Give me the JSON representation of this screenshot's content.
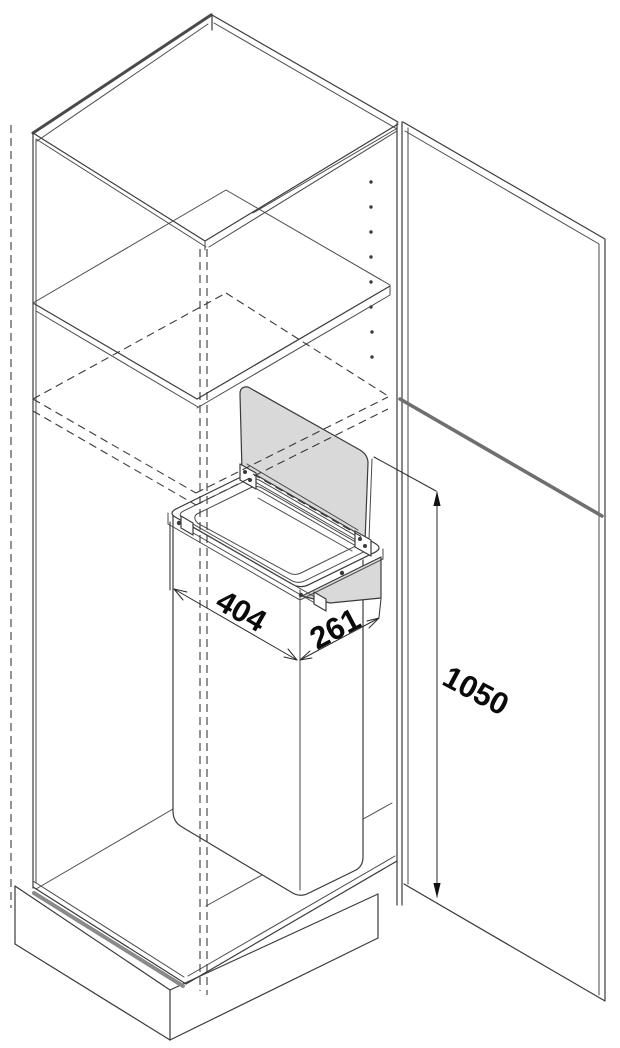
{
  "diagram": {
    "type": "technical-line-drawing",
    "subject": "built-in waste bin with lift lid mounted in tall cabinet with open door",
    "projection": "isometric"
  },
  "dimensions": {
    "width_mm": "404",
    "depth_mm": "261",
    "door_height_mm": "1050"
  },
  "colors": {
    "background": "#ffffff",
    "line": "#3b3b3b",
    "lid_fill": "#d9d9d9",
    "thick_plinth_edge": "#8a8a8a",
    "door_divider": "#6f6f6f"
  }
}
